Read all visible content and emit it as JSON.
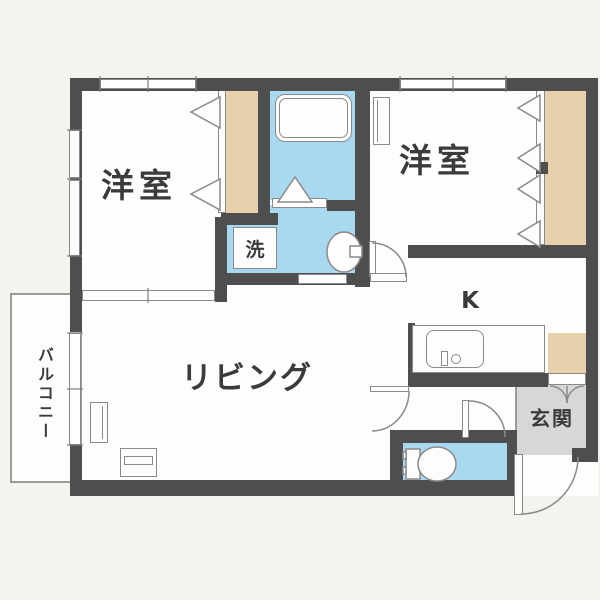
{
  "floorplan": {
    "type": "apartment-floor-plan",
    "rooms": {
      "bedroom_left": {
        "label": "洋室"
      },
      "bedroom_right": {
        "label": "洋室"
      },
      "living": {
        "label": "リビング"
      },
      "kitchen": {
        "label": "K"
      },
      "entrance": {
        "label": "玄関"
      },
      "laundry": {
        "label": "洗"
      },
      "balcony": {
        "label": "バルコニー"
      }
    },
    "colors": {
      "wall": "#4e4e4e",
      "water_area": "#a9d9f1",
      "closet": "#e7d1ad",
      "entrance_floor": "#d7d7d7",
      "room_floor": "#fdfdfb",
      "background": "#f5f3ee",
      "outline": "#8a8a8a",
      "text": "#3b3b3b"
    }
  }
}
